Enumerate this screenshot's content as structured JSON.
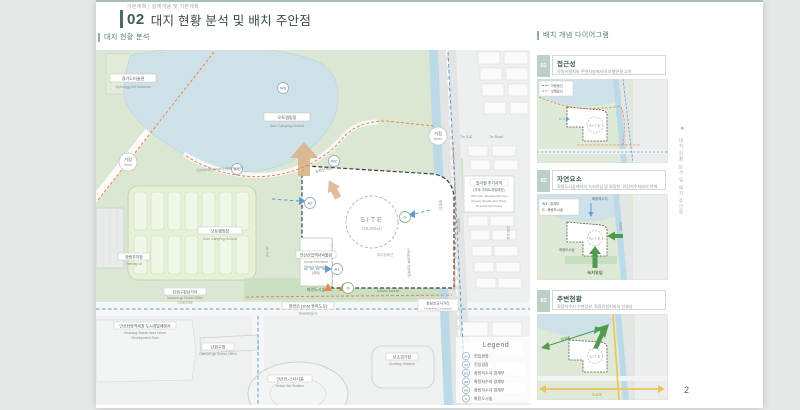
{
  "header": {
    "eyebrow": "기본계획  |  설계개념 및 기본계획",
    "chapter_no": "02",
    "title": "대지 현황 분석 및 배치 주안점",
    "section_left": "대지 현황 분석",
    "section_right": "배치 개념 다이어그램"
  },
  "edge": {
    "marker": "❖",
    "vertical_text": "대지 현황 분석 및 배치 주안점",
    "page_number": "2"
  },
  "colors": {
    "accent": "#47705f",
    "accent_bar": "#8fae9f",
    "vehicle_route": "#5e9bd3",
    "pedestrian_route": "#e8854f",
    "green_arrow": "#4e9a4e",
    "road_axis": "#ecc45f",
    "view_arrow": "#d9b28c",
    "park_green": "#dbe7d3",
    "lake_blue": "#cfe1e8",
    "stream_blue": "#badae7"
  },
  "map": {
    "labels": {
      "art_museum_ko": "경기도미술관",
      "art_museum_en": "Gyeonggi Art Museum",
      "lake_camp_ko": "오토캠핑장",
      "lake_camp_en": "Auto Camping Ground",
      "node_ko": "거점",
      "node_en": "Node",
      "trekking": "Circumference trekking way",
      "loop_trail": "순환산책로",
      "w1": "W1",
      "w2": "W2",
      "w3": "W3",
      "a1": "A1",
      "a2": "A2",
      "g": "G",
      "site": "SITE",
      "site_area": "(25,000㎡)",
      "boundary": "대지경계선",
      "museum_ko": "안산산업역사박물관",
      "museum_en1": "Ansan Industrial",
      "museum_en2": "History Museum",
      "museum_note": "(예정)",
      "camp_ko": "오토캠핑장",
      "camp_en": "Auto Camping Ground",
      "parking_ko": "화랑주차장",
      "parking_en": "Parking lot",
      "forest_ko": "화랑도시숲",
      "forest_en": "Urban forest",
      "road_main_ko": "화랑로 (30M 광폭도로)",
      "road_main_en": "Hwarang-ro",
      "cross1_ko": "단원구청삼거리",
      "cross1_en1": "Danwon-gu District Office",
      "cross1_en2": "Crossroad",
      "devzone_ko": "안산화랑역세권 도시개발예정지",
      "devzone_en1": "Hwarang Station Area Urban",
      "devzone_en2": "Development Zone",
      "danwon_ko": "단원구청",
      "danwon_en": "Danwon-gu District Office",
      "aux_ko": "보조경기장",
      "aux_en": "Auxiliary Stadium",
      "stadium_ko": "안산와~스타디움",
      "stadium_en": "Ansan Wa Stadium",
      "villa_ko1": "빌라형 주거지역",
      "villa_ko2": "(추후 아파트개발예정)",
      "villa_en1": "Villa Type Residential Area",
      "villa_en2": "(Future Residential Tower",
      "villa_en3": "Development Area)",
      "road7_ko": "7m 도로",
      "road7_en": "7m Road",
      "road20": "20M 도로",
      "road3": "3M 도로",
      "stream": "화랑천",
      "streamside": "화랑천변로",
      "promenade": "산책로(향후 조성예정)",
      "cross2_ko": "화랑초교사거리",
      "cross2_en": "Hwarang Crossroad"
    },
    "legend": {
      "title": "Legend",
      "items": [
        {
          "badge": "A1",
          "label": "진입광장"
        },
        {
          "badge": "A2",
          "label": "진입광장"
        },
        {
          "badge": "W1",
          "label": "화랑저수지 경계부"
        },
        {
          "badge": "W2",
          "label": "화랑저수지 경계부"
        },
        {
          "badge": "W3",
          "label": "화랑저수지 경계부"
        },
        {
          "badge": "G",
          "label": "화랑도시숲"
        }
      ]
    }
  },
  "diagrams": [
    {
      "no": "01",
      "title": "접근성",
      "subtitle": "화랑유원지와 주변시설에서의 보행연결 고려",
      "legend": [
        {
          "label": "차량동선"
        },
        {
          "label": "보행동선"
        }
      ],
      "site": "SITE"
    },
    {
      "no": "02",
      "title": "자연요소",
      "subtitle": "화랑도시숲에서의 녹지유입 및 화랑천, 화랑저수지와의 연계",
      "callout_line1": "W3 : 경계부",
      "callout_line2": "G : 화랑도시숲",
      "labels": {
        "reservoir": "화랑저수지",
        "forest": "화랑도시숲",
        "inflow": "녹지유입",
        "stream": "화랑천"
      },
      "site": "SITE"
    },
    {
      "no": "03",
      "title": "주변현황",
      "subtitle": "화랑저수지 수변경관, 화랑유원지와의 연결성",
      "labels": {
        "nature_axis": "자연축",
        "road_axis": "도로축"
      },
      "site": "SITE"
    }
  ]
}
